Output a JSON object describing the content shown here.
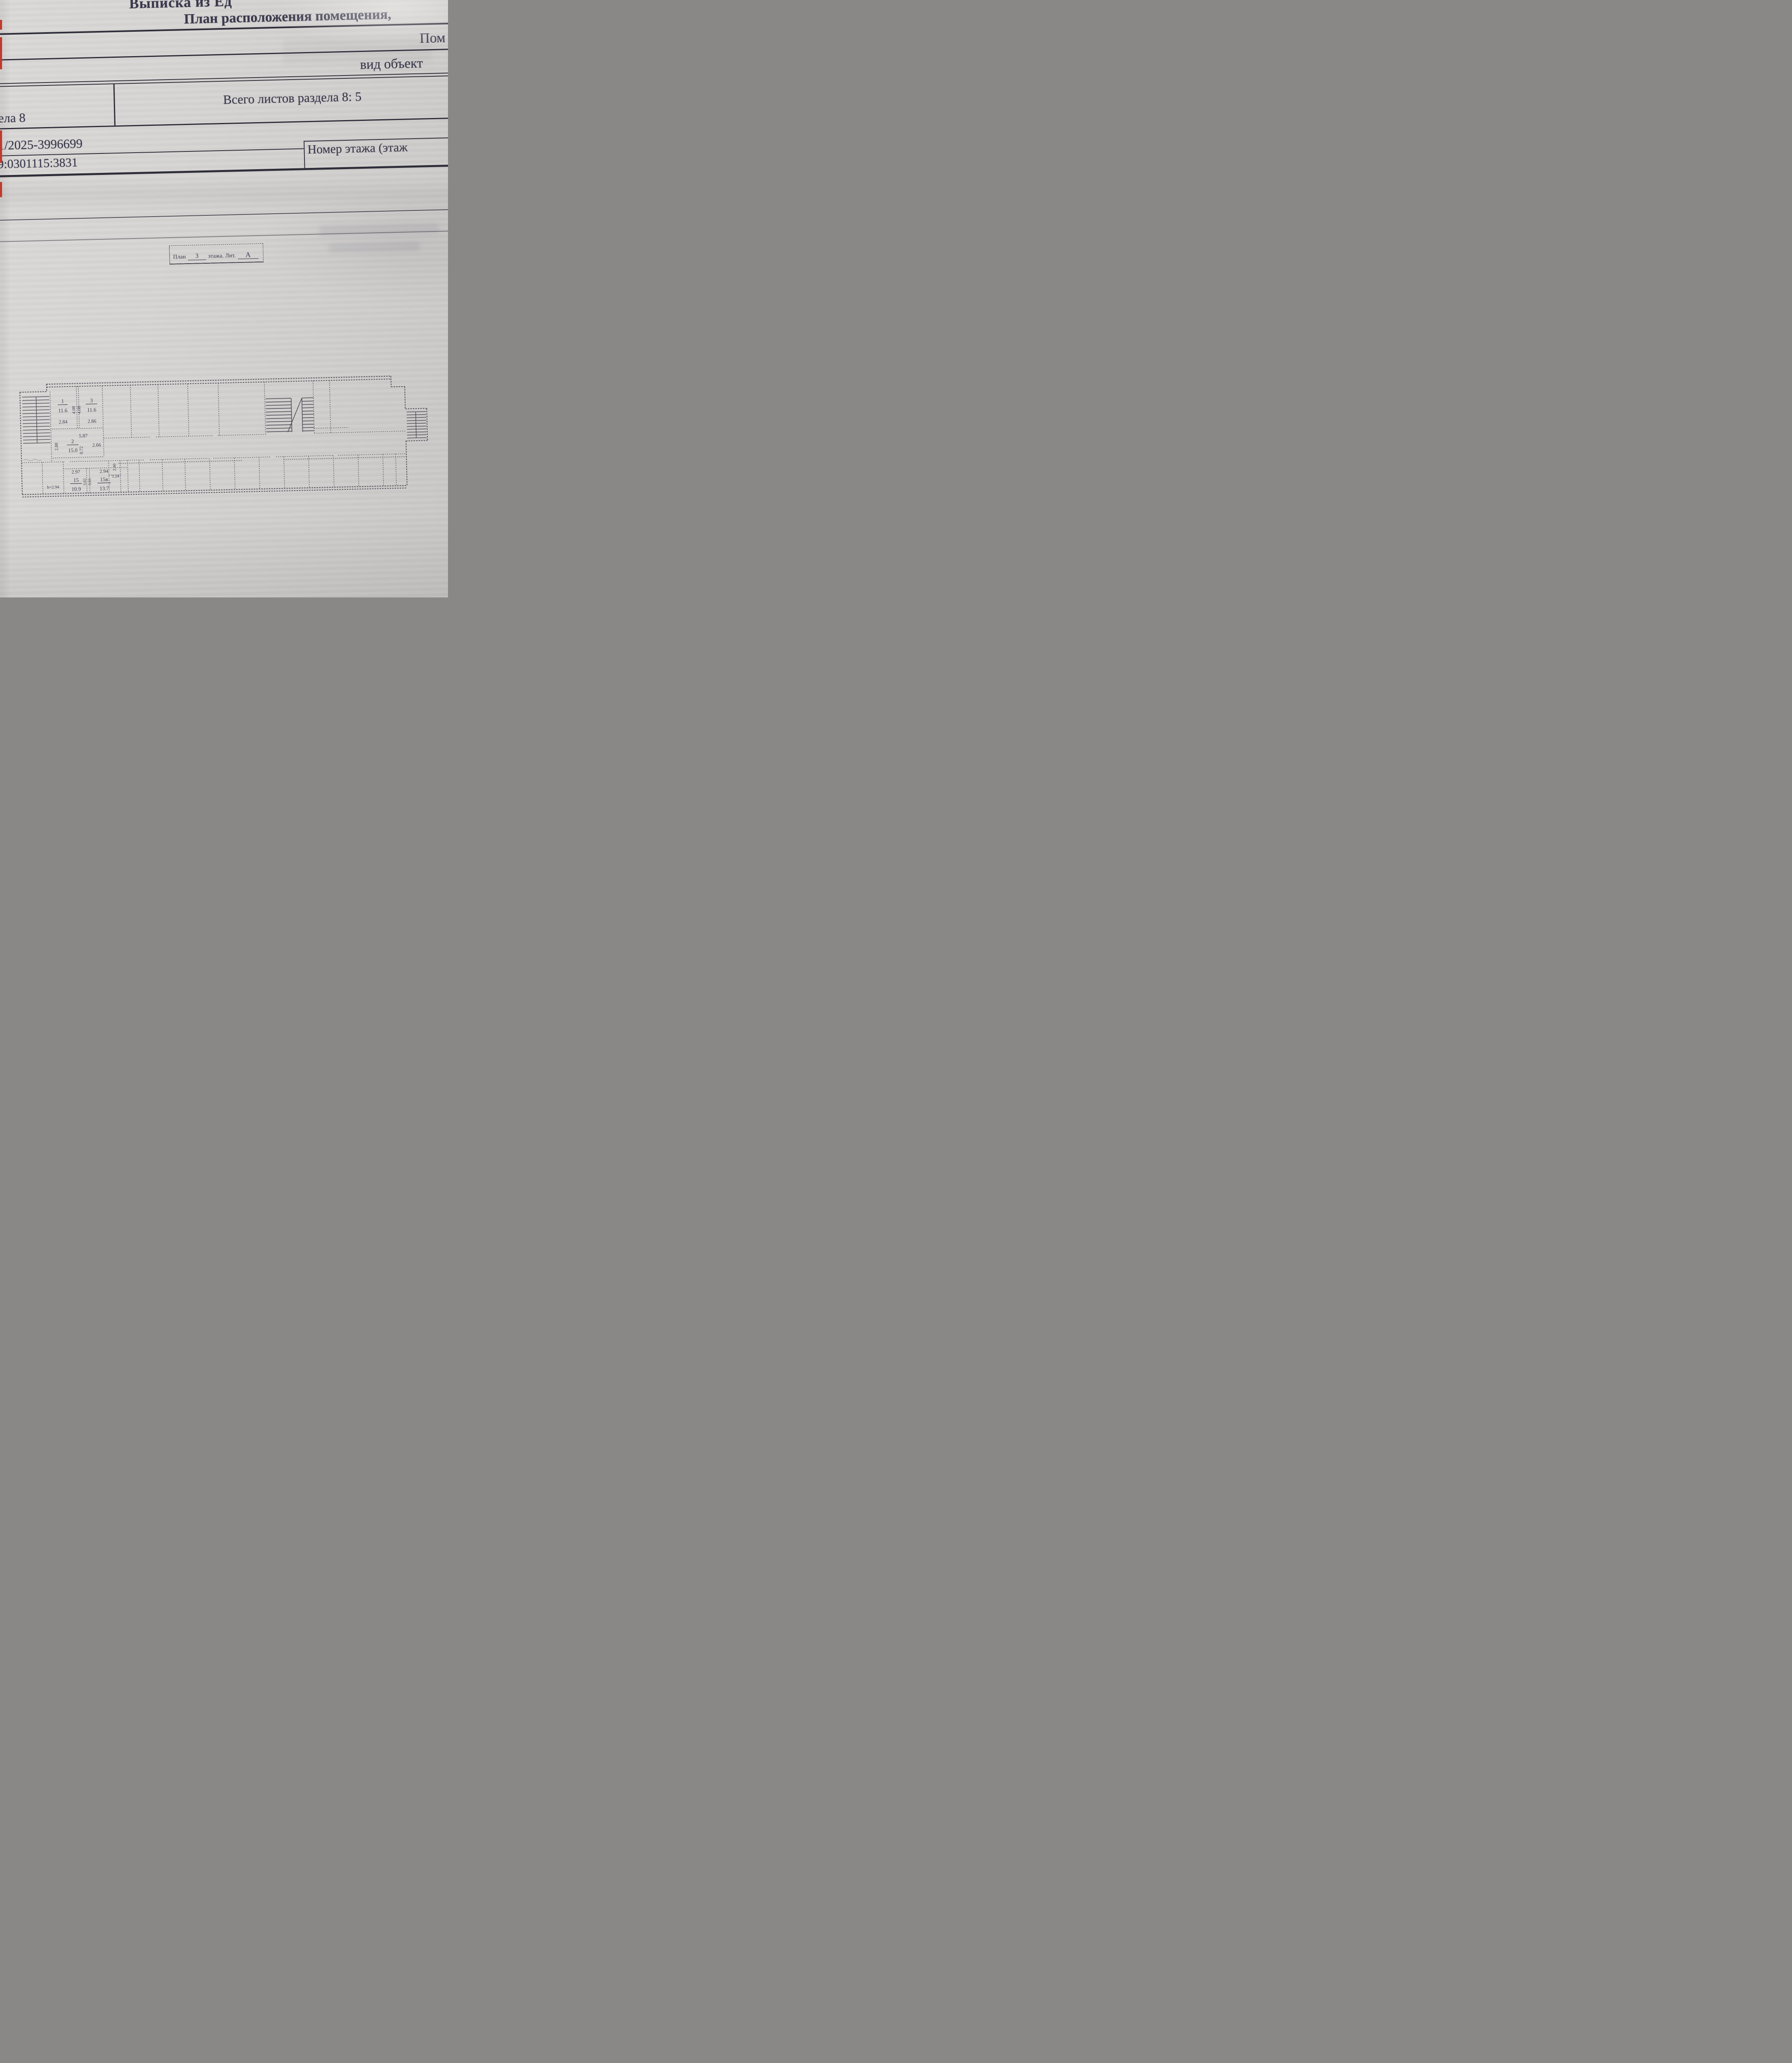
{
  "header": {
    "extract_title_partial": "Выписка из Ед",
    "plan_title_partial": "План расположения помещения,",
    "premises_partial": "Пом",
    "object_kind_partial": "вид объект"
  },
  "table": {
    "sheets_total": "Всего листов раздела 8: 5",
    "section_tail_partial": "ела 8",
    "extract_no_partial": "1/2025-3996699",
    "cadastral_no_partial": "9:0301115:3831",
    "floor_no_label_partial": "Номер этажа (этаж"
  },
  "caption": {
    "plan_word": "План",
    "floor_value": "3",
    "floor_word": "этажа. Лит.",
    "liter_value": "А"
  },
  "plan": {
    "room1": {
      "num": "1",
      "area": "11.6",
      "width": "2.84"
    },
    "room3": {
      "num": "3",
      "area": "11.6",
      "width": "2.86"
    },
    "room2": {
      "num": "2",
      "area": "15.0",
      "top": "5.87",
      "mid": "0.72",
      "right": "2.66",
      "left": "2.88"
    },
    "depth_a": "4.08",
    "depth_b": "4.08",
    "room15": {
      "num": "15",
      "area": "10.9",
      "width": "2.97"
    },
    "room15v": {
      "num": "15в",
      "area": "13.7",
      "width": "2.94"
    },
    "wall_a": "3.65",
    "wall_b": "3.65",
    "nook_w": "1.24",
    "nook_h": "2.40",
    "height_note": "h=2.94"
  }
}
